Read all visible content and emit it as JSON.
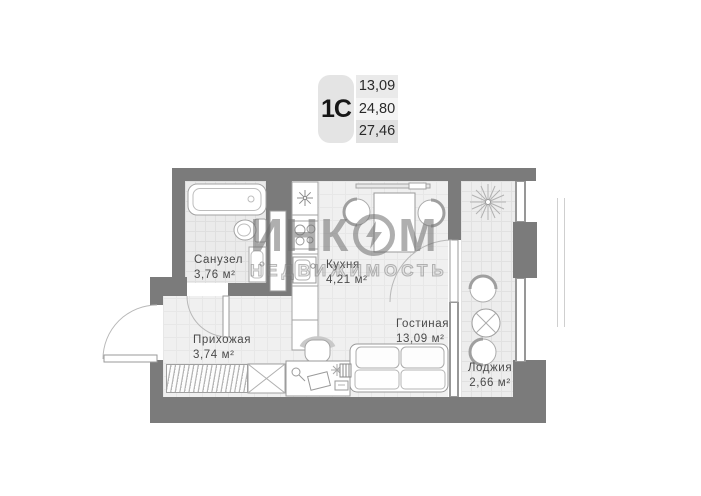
{
  "info_card": {
    "type_label": "1С",
    "values": [
      "13,09",
      "24,80",
      "27,46"
    ]
  },
  "rooms": [
    {
      "name": "Санузел",
      "area": "3,76 м²"
    },
    {
      "name": "Кухня",
      "area": "4,21 м²"
    },
    {
      "name": "Прихожая",
      "area": "3,74 м²"
    },
    {
      "name": "Гостиная",
      "area": "13,09 м²"
    },
    {
      "name": "Лоджия",
      "area": "2,66 м²"
    }
  ],
  "watermark": {
    "brand_left": "ИНК",
    "brand_right": "М",
    "subtitle": "НЕДВИЖИМОСТЬ",
    "logo_icon": "incom-ring-bolt-icon"
  },
  "colors": {
    "wall": "#7b7b7b",
    "floor": "#f0f0f0",
    "label_text": "#4a4a4a"
  }
}
